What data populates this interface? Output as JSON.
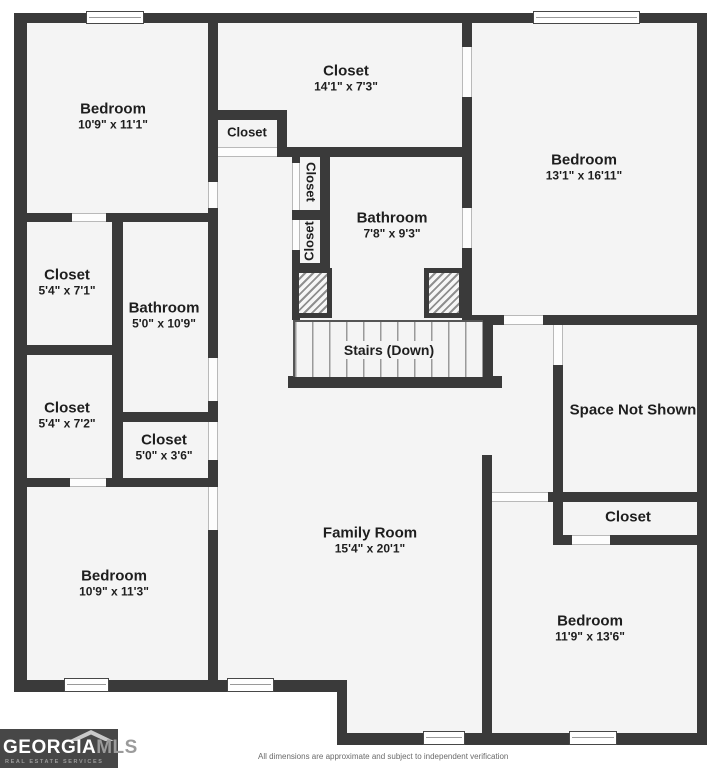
{
  "floorplan": {
    "rooms": [
      {
        "name": "Bedroom",
        "dims": "10'9\" x 11'1\""
      },
      {
        "name": "Closet",
        "dims": "14'1\" x 7'3\""
      },
      {
        "name": "Closet"
      },
      {
        "name": "Closet"
      },
      {
        "name": "Closet"
      },
      {
        "name": "Bedroom",
        "dims": "13'1\" x 16'11\""
      },
      {
        "name": "Bathroom",
        "dims": "7'8\" x 9'3\""
      },
      {
        "name": "Closet",
        "dims": "5'4\" x 7'1\""
      },
      {
        "name": "Bathroom",
        "dims": "5'0\" x 10'9\""
      },
      {
        "name": "Closet",
        "dims": "5'4\" x 7'2\""
      },
      {
        "name": "Closet",
        "dims": "5'0\" x 3'6\""
      },
      {
        "name": "Space Not Shown"
      },
      {
        "name": "Closet"
      },
      {
        "name": "Family Room",
        "dims": "15'4\" x 20'1\""
      },
      {
        "name": "Bedroom",
        "dims": "10'9\" x 11'3\""
      },
      {
        "name": "Bedroom",
        "dims": "11'9\" x 13'6\""
      }
    ],
    "stairs_label": "Stairs (Down)"
  },
  "branding": {
    "logo_primary": "GEORGIA",
    "logo_secondary": "MLS",
    "logo_tagline": "REAL ESTATE SERVICES"
  },
  "footer": {
    "disclaimer": "All dimensions are approximate and subject to independent verification"
  },
  "colors": {
    "wall": "#3a3a3a",
    "floor": "#f4f4f4",
    "outside": "#ffffff",
    "logo_bg": "#474747"
  }
}
